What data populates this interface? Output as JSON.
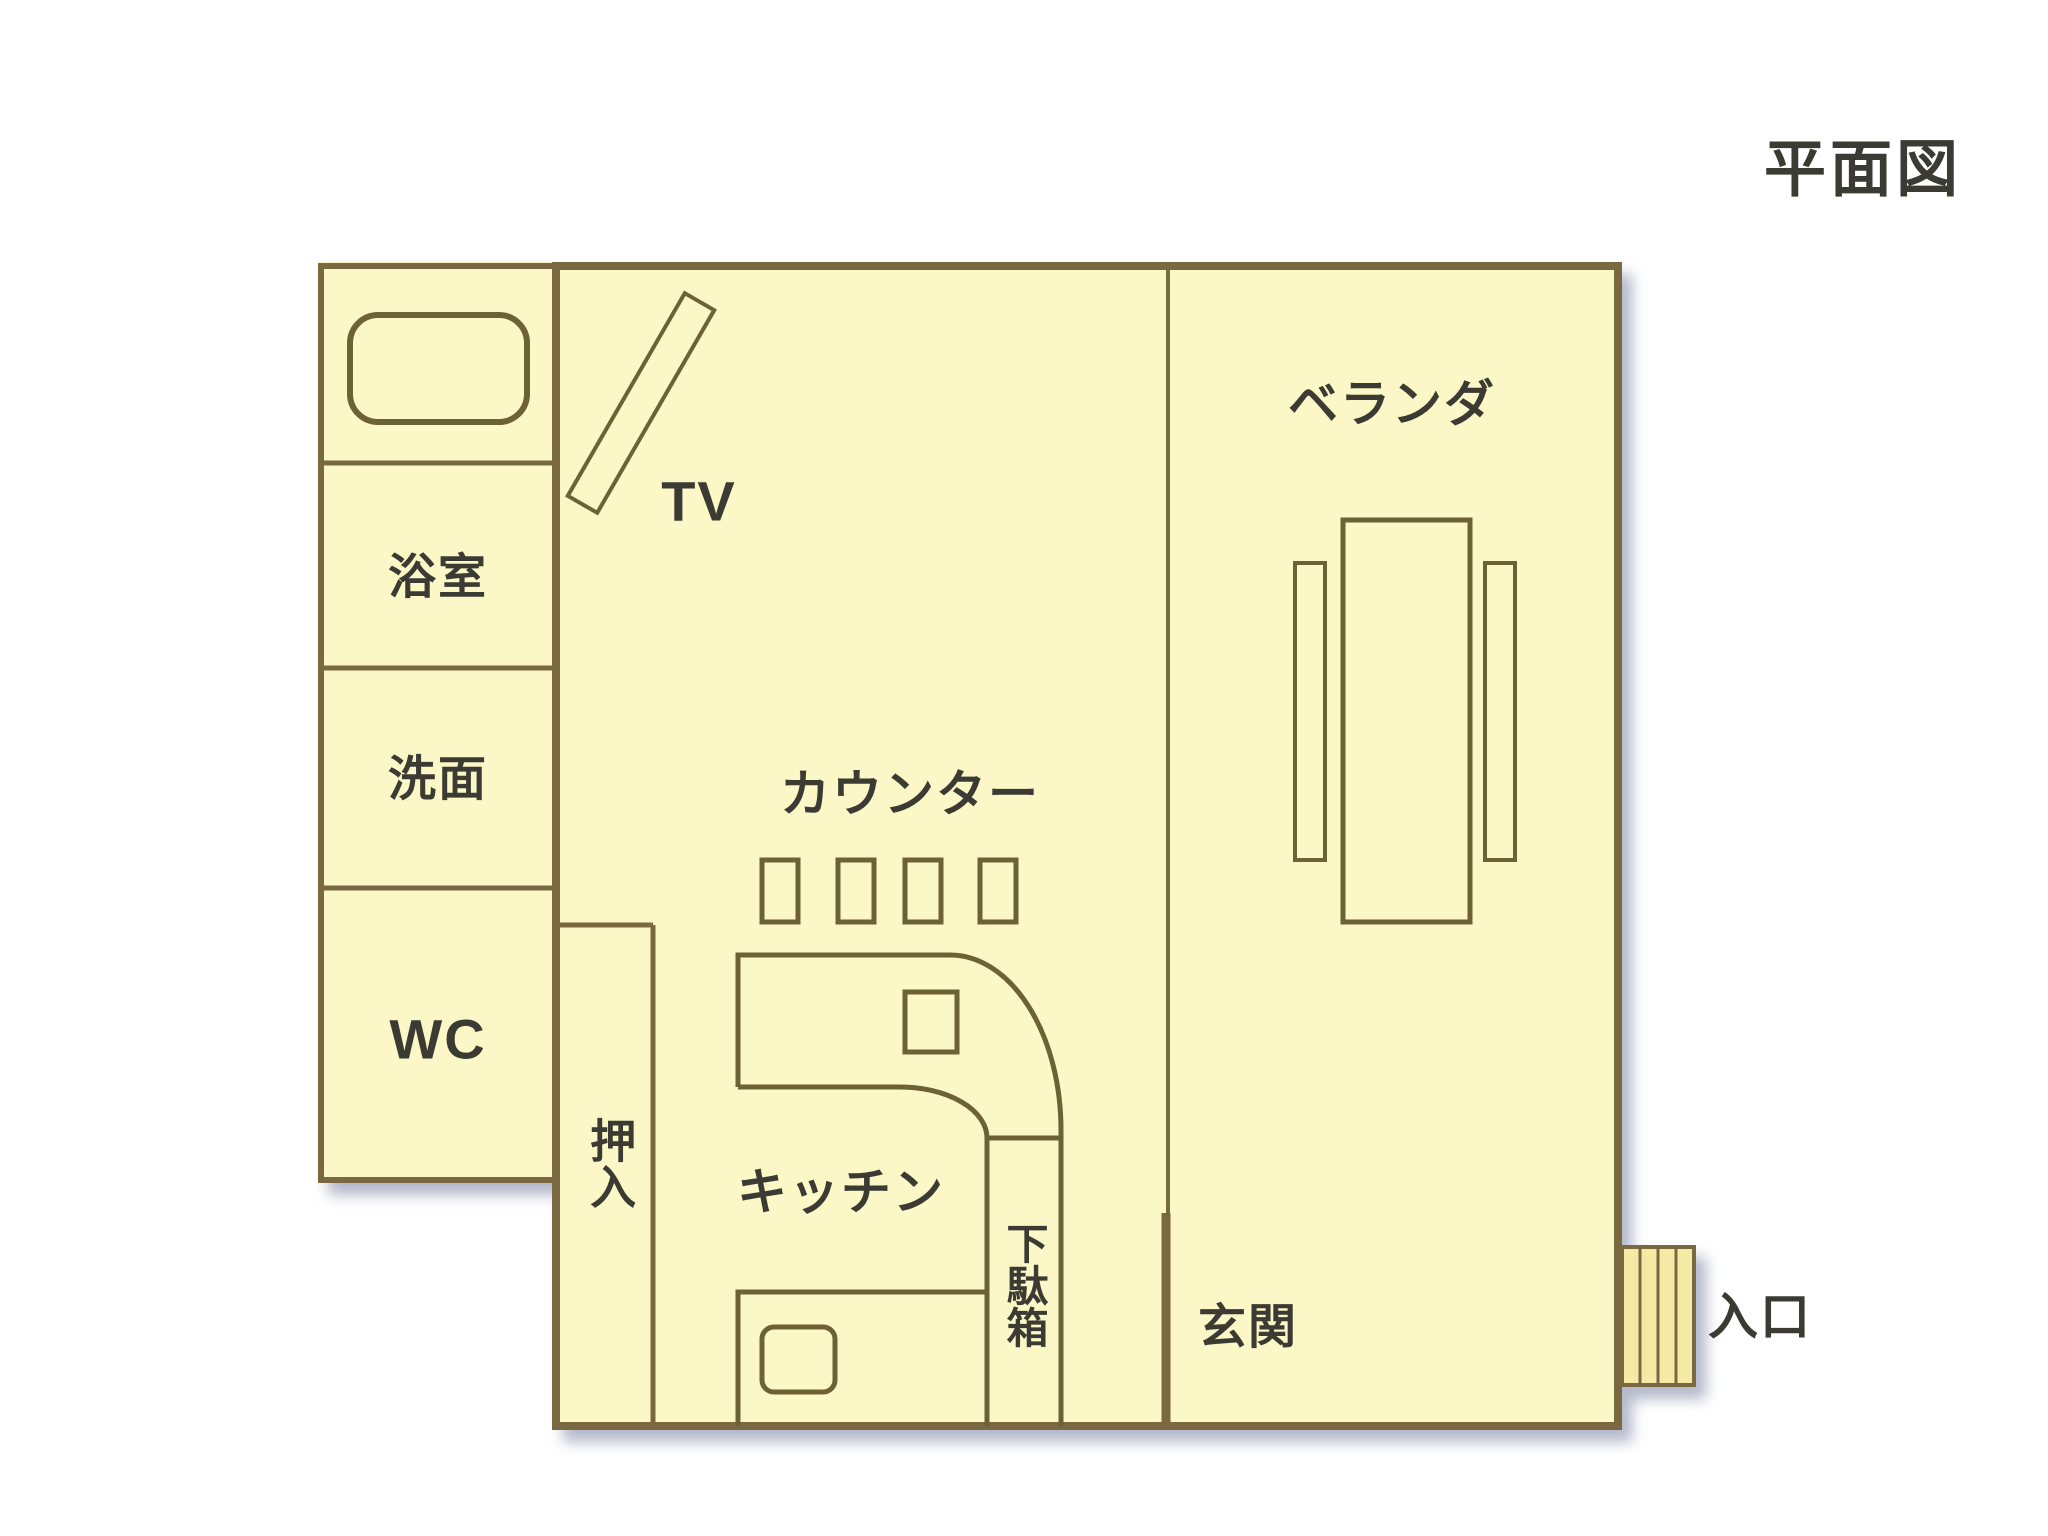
{
  "title": "平面図",
  "labels": {
    "bathroom": "浴室",
    "washbasin": "洗面",
    "wc": "WC",
    "tv": "TV",
    "counter": "カウンター",
    "kitchen": "キッチン",
    "closet": "押入",
    "shoe_cabinet": "下駄箱",
    "entrance_hall": "玄関",
    "veranda": "ベランダ",
    "entrance": "入口"
  },
  "colors": {
    "room_fill": "#fbf7c6",
    "door_fill": "#f5e9a6",
    "wall": "#7a6840",
    "furniture": "#6d6136",
    "text": "#3b3b33",
    "shadow": "#9aa0b8"
  }
}
